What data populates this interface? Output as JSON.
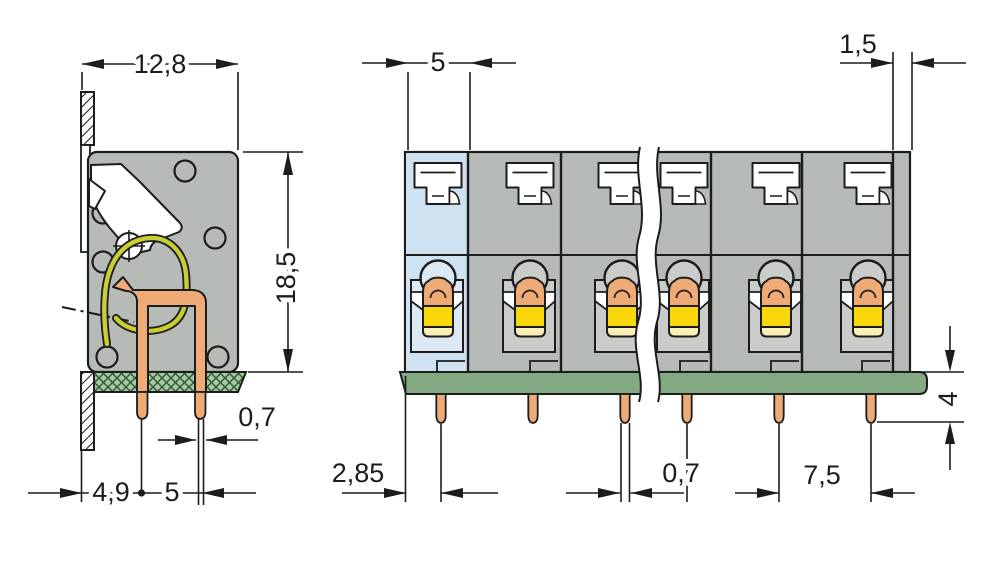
{
  "drawing": {
    "component": "pcb-terminal-block-dimension-drawing",
    "side_view": {
      "dims": {
        "total_depth": "12,8",
        "height": "18,5",
        "pin_tip_width": "0,7",
        "wall_to_pin": "4,9",
        "pin_row_spacing": "5"
      }
    },
    "front_view": {
      "poles_visible": 6,
      "dims": {
        "pole_width": "5",
        "end_wall": "1,5",
        "edge_to_pin": "2,85",
        "pin_width": "0,7",
        "pin_pitch": "7,5",
        "pin_length": "4"
      }
    },
    "colors": {
      "housing": "#b7bbb7",
      "recess": "#caccca",
      "highlight": "#cfe2f1",
      "highlight_recess": "#dce9f5",
      "copper": "#eeab76",
      "clamp_yellow": "#f9d70a",
      "spring": "#c9cf33",
      "pcb": "#84aa84",
      "line": "#1c1c1c"
    }
  }
}
